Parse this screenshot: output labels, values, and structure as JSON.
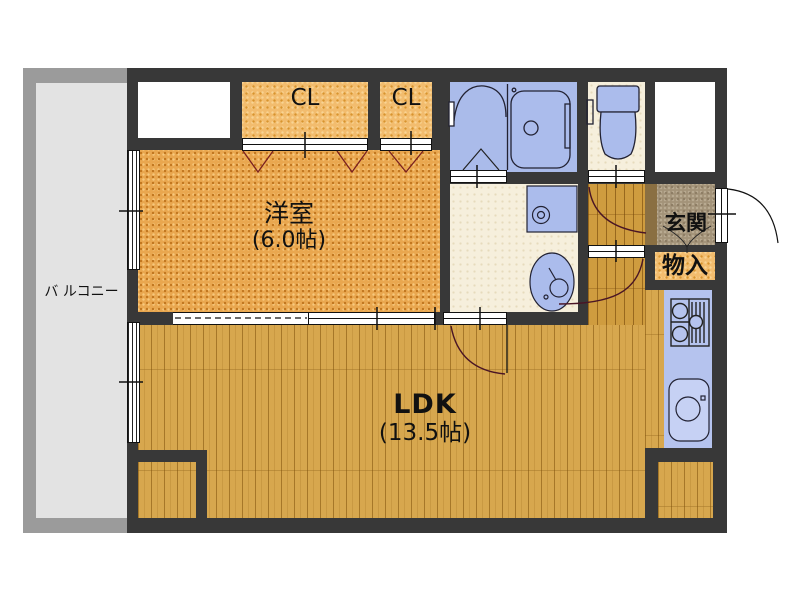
{
  "balcony": {
    "label": "バ ルコニー"
  },
  "rooms": {
    "western": {
      "name": "洋室",
      "size": "(6.0帖)"
    },
    "ldk": {
      "name": "LDK",
      "size": "(13.5帖)"
    },
    "closet1": {
      "label": "CL"
    },
    "closet2": {
      "label": "CL"
    },
    "genkan": {
      "label": "玄関"
    },
    "storage": {
      "label": "物入"
    }
  },
  "fixtures": [
    "unit-bath",
    "bathtub",
    "toilet",
    "washing-machine-pan",
    "vanity-sink",
    "gas-stove",
    "kitchen-sink"
  ],
  "colors": {
    "wall": "#383838",
    "balcony_floor": "#e3e3e3",
    "balcony_frame": "#9b9b9b",
    "western_floor": "#e9a74f",
    "closet_floor": "#f2bc6e",
    "ldk_floor": "#d7a74e",
    "wet_area_floor": "#f6efdc",
    "fixture_blue": "#aabbea",
    "kitchen_counter": "#b5c3ee",
    "genkan_tile": "#a39379",
    "door_swing_arc": "#4a1525"
  }
}
